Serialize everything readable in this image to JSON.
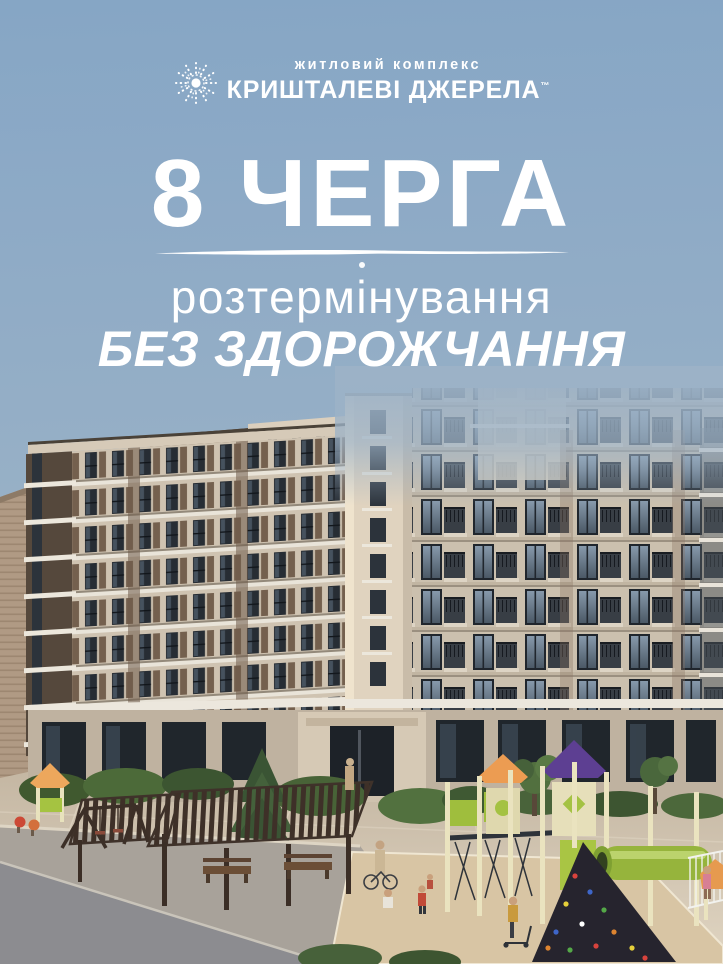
{
  "page": {
    "width": 723,
    "height": 964,
    "kind": "residential-complex-advertising-poster"
  },
  "logo": {
    "icon": "starburst-sparkle-icon",
    "subtitle": "житловий комплекс",
    "title": "КРИШТАЛЕВІ ДЖЕРЕЛА",
    "trademark": "™"
  },
  "headline": {
    "phase": "8 ЧЕРГА",
    "line1": "розтермінування",
    "line2": "БЕЗ ЗДОРОЖЧАННЯ"
  },
  "colors": {
    "sky": "#92adc5",
    "text": "#ffffff",
    "facade_cream": "#cfc3b1",
    "facade_taupe": "#cbc0ae",
    "panel_brown": "#74604e",
    "window_dark": "#252b33",
    "glass_blue": "#6d8196",
    "slab_white": "#ece7dd",
    "pavement": "#cfc2ae",
    "sand_pad": "#d8c5a4",
    "road_gray": "#8c8c90",
    "bush_green": "#4a633a",
    "play_lime": "#9fbe3d",
    "play_cream": "#e8e2bd",
    "roof_orange": "#ec9c52",
    "roof_purple": "#5d3f92",
    "pergola_brown": "#3b2e26"
  },
  "scene": {
    "elements": [
      "apartment-buildings",
      "building-entrance",
      "courtyard",
      "pergolas",
      "playground-left",
      "playground-right",
      "swing-set",
      "tube-slide",
      "climbing-wall",
      "conifer-tree",
      "bushes",
      "road",
      "people"
    ]
  }
}
